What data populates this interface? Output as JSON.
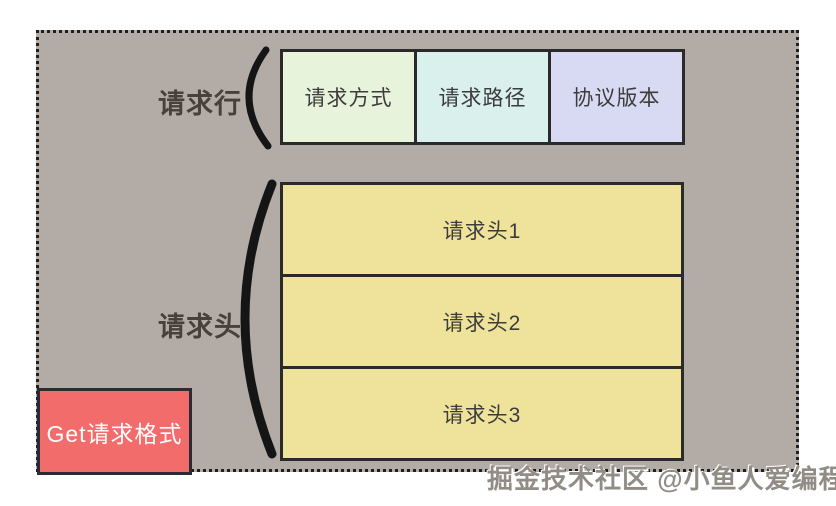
{
  "diagram": {
    "title_box": {
      "label": "Get请求格式",
      "bg": "#f26c6c",
      "text_color": "#ffffff"
    },
    "request_line": {
      "label": "请求行",
      "boxes": [
        {
          "label": "请求方式",
          "bg": "#e7f3da"
        },
        {
          "label": "请求路径",
          "bg": "#d9f0ed"
        },
        {
          "label": "协议版本",
          "bg": "#d8daf3"
        }
      ]
    },
    "request_headers": {
      "label": "请求头",
      "boxes": [
        {
          "label": "请求头1",
          "bg": "#efe39b"
        },
        {
          "label": "请求头2",
          "bg": "#efe39b"
        },
        {
          "label": "请求头3",
          "bg": "#efe39b"
        }
      ]
    },
    "watermark": "掘金技术社区 @小鱼人爱编程",
    "colors": {
      "page_bg": "#ffffff",
      "panel_bg": "#b3aba6",
      "panel_border": "#1f1f1f",
      "box_border": "#2a2a2a",
      "label_text": "#46413a",
      "box_text": "#3c3c3c",
      "brace": "#151515",
      "watermark_text": "#928c86"
    }
  }
}
